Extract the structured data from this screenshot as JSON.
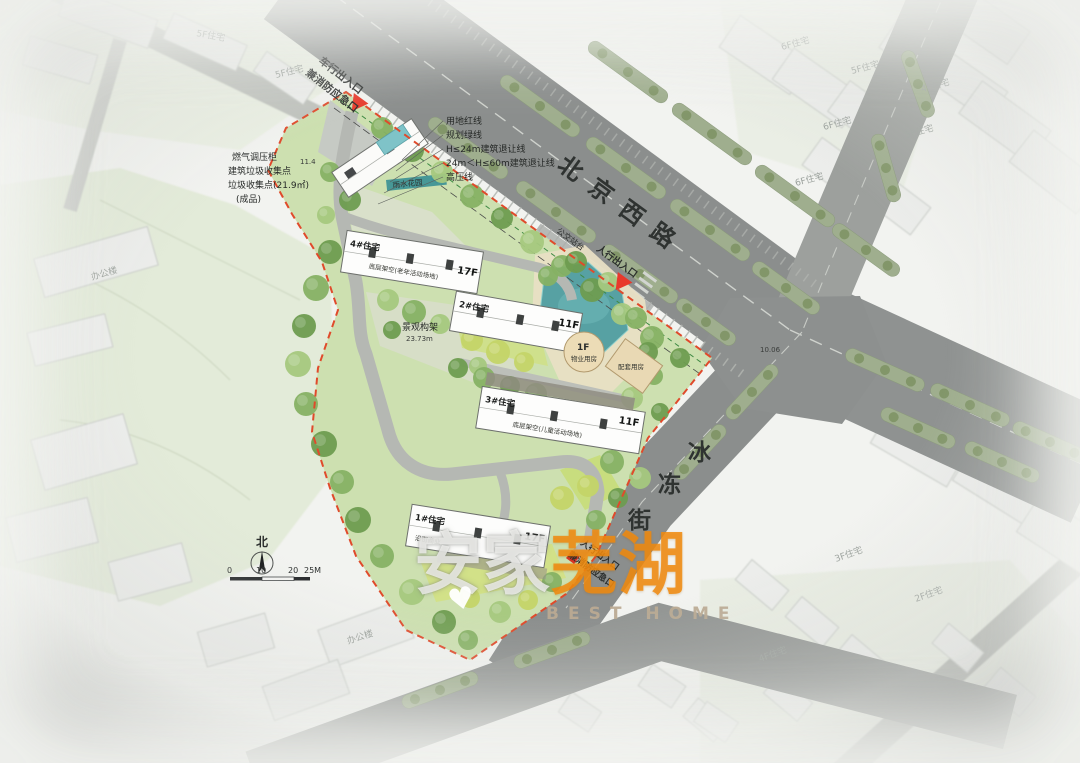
{
  "roads": {
    "beijing": "北京西路",
    "bingdong": [
      "冰",
      "冻",
      "街"
    ],
    "junction_elev": "10.06",
    "bus_stop": "公交站台"
  },
  "entrances": {
    "vehicle_line1": "车行出入口",
    "vehicle_line2": "兼消防应急口",
    "ped_north": "人行出入口",
    "ped_south_line1": "人行出入口",
    "ped_south_line2": "兼消防应急口"
  },
  "setback_lines": [
    "用地红线",
    "规划绿线",
    "H≤24m建筑退让线",
    "24m＜H≤60m建筑退让线",
    "高压线"
  ],
  "utility_notes": [
    "燃气调压柜",
    "建筑垃圾收集点",
    "垃圾收集点(21.9㎡)",
    "(成品)"
  ],
  "elev_note": "11.4",
  "site": {
    "residential": [
      {
        "no": "4#住宅",
        "floors": "17F",
        "note": "底层架空(老年活动场地)"
      },
      {
        "no": "2#住宅",
        "floors": "11F",
        "note": ""
      },
      {
        "no": "3#住宅",
        "floors": "11F",
        "note": "底层架空(儿童活动场地)"
      },
      {
        "no": "1#住宅",
        "floors": "17F",
        "note": "沿街商业"
      }
    ],
    "amenity": {
      "round_label": "1F",
      "round_note": "物业用房",
      "east_note": "配套用房"
    },
    "pergola": "景观构架",
    "pergola_elev": "23.73m",
    "rain_garden": "雨水花园"
  },
  "compass": {
    "north": "北"
  },
  "scale": {
    "t0": "0",
    "t1": "10",
    "t2": "20",
    "t3": "25M"
  },
  "watermark": {
    "part1": "安家",
    "part2": "芜湖",
    "sub": "BEST HOME",
    "heart": "♥"
  },
  "context_labels": [
    "5F住宅",
    "6F住宅",
    "5F住宅",
    "4F住宅",
    "6F住宅",
    "5F住宅",
    "6F住宅",
    "办公楼",
    "办公楼",
    "3F住宅",
    "2F住宅",
    "4F住宅",
    "5F住宅"
  ]
}
